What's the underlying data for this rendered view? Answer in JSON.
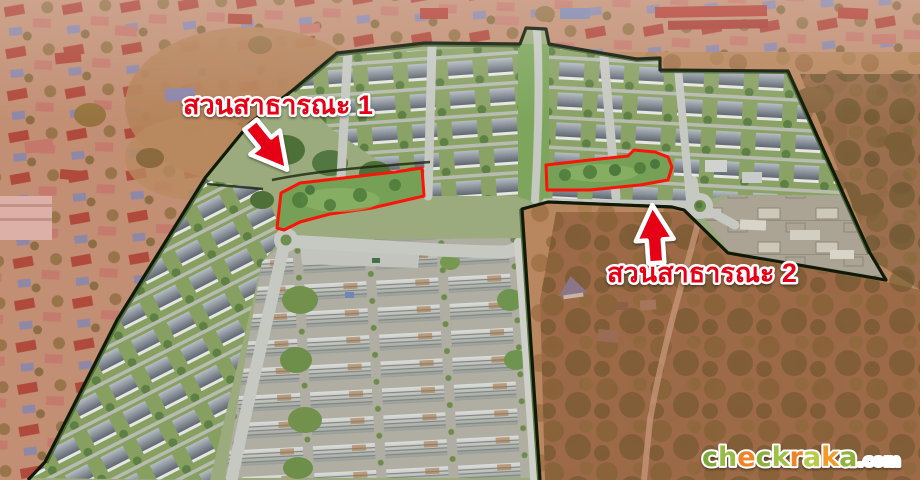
{
  "annotations": {
    "annotation_red": "#e60012",
    "park_outline_red": "#fb1408",
    "boundary_black": "#101a08",
    "park1": {
      "label": "สวนสาธารณะ 1"
    },
    "park2": {
      "label": "สวนสาธารณะ 2"
    }
  },
  "watermark": {
    "suffix": ".com",
    "suffix_color": "#ffffff",
    "letters": [
      {
        "ch": "c",
        "color": "#7fa83b"
      },
      {
        "ch": "h",
        "color": "#96bc43"
      },
      {
        "ch": "e",
        "color": "#ef8325"
      },
      {
        "ch": "c",
        "color": "#8bb03e"
      },
      {
        "ch": "k",
        "color": "#a0c047"
      },
      {
        "ch": "r",
        "color": "#ef8325"
      },
      {
        "ch": "a",
        "color": "#b8cb4a"
      },
      {
        "ch": "k",
        "color": "#f29b2a"
      },
      {
        "ch": "a",
        "color": "#8fb23c"
      }
    ]
  }
}
